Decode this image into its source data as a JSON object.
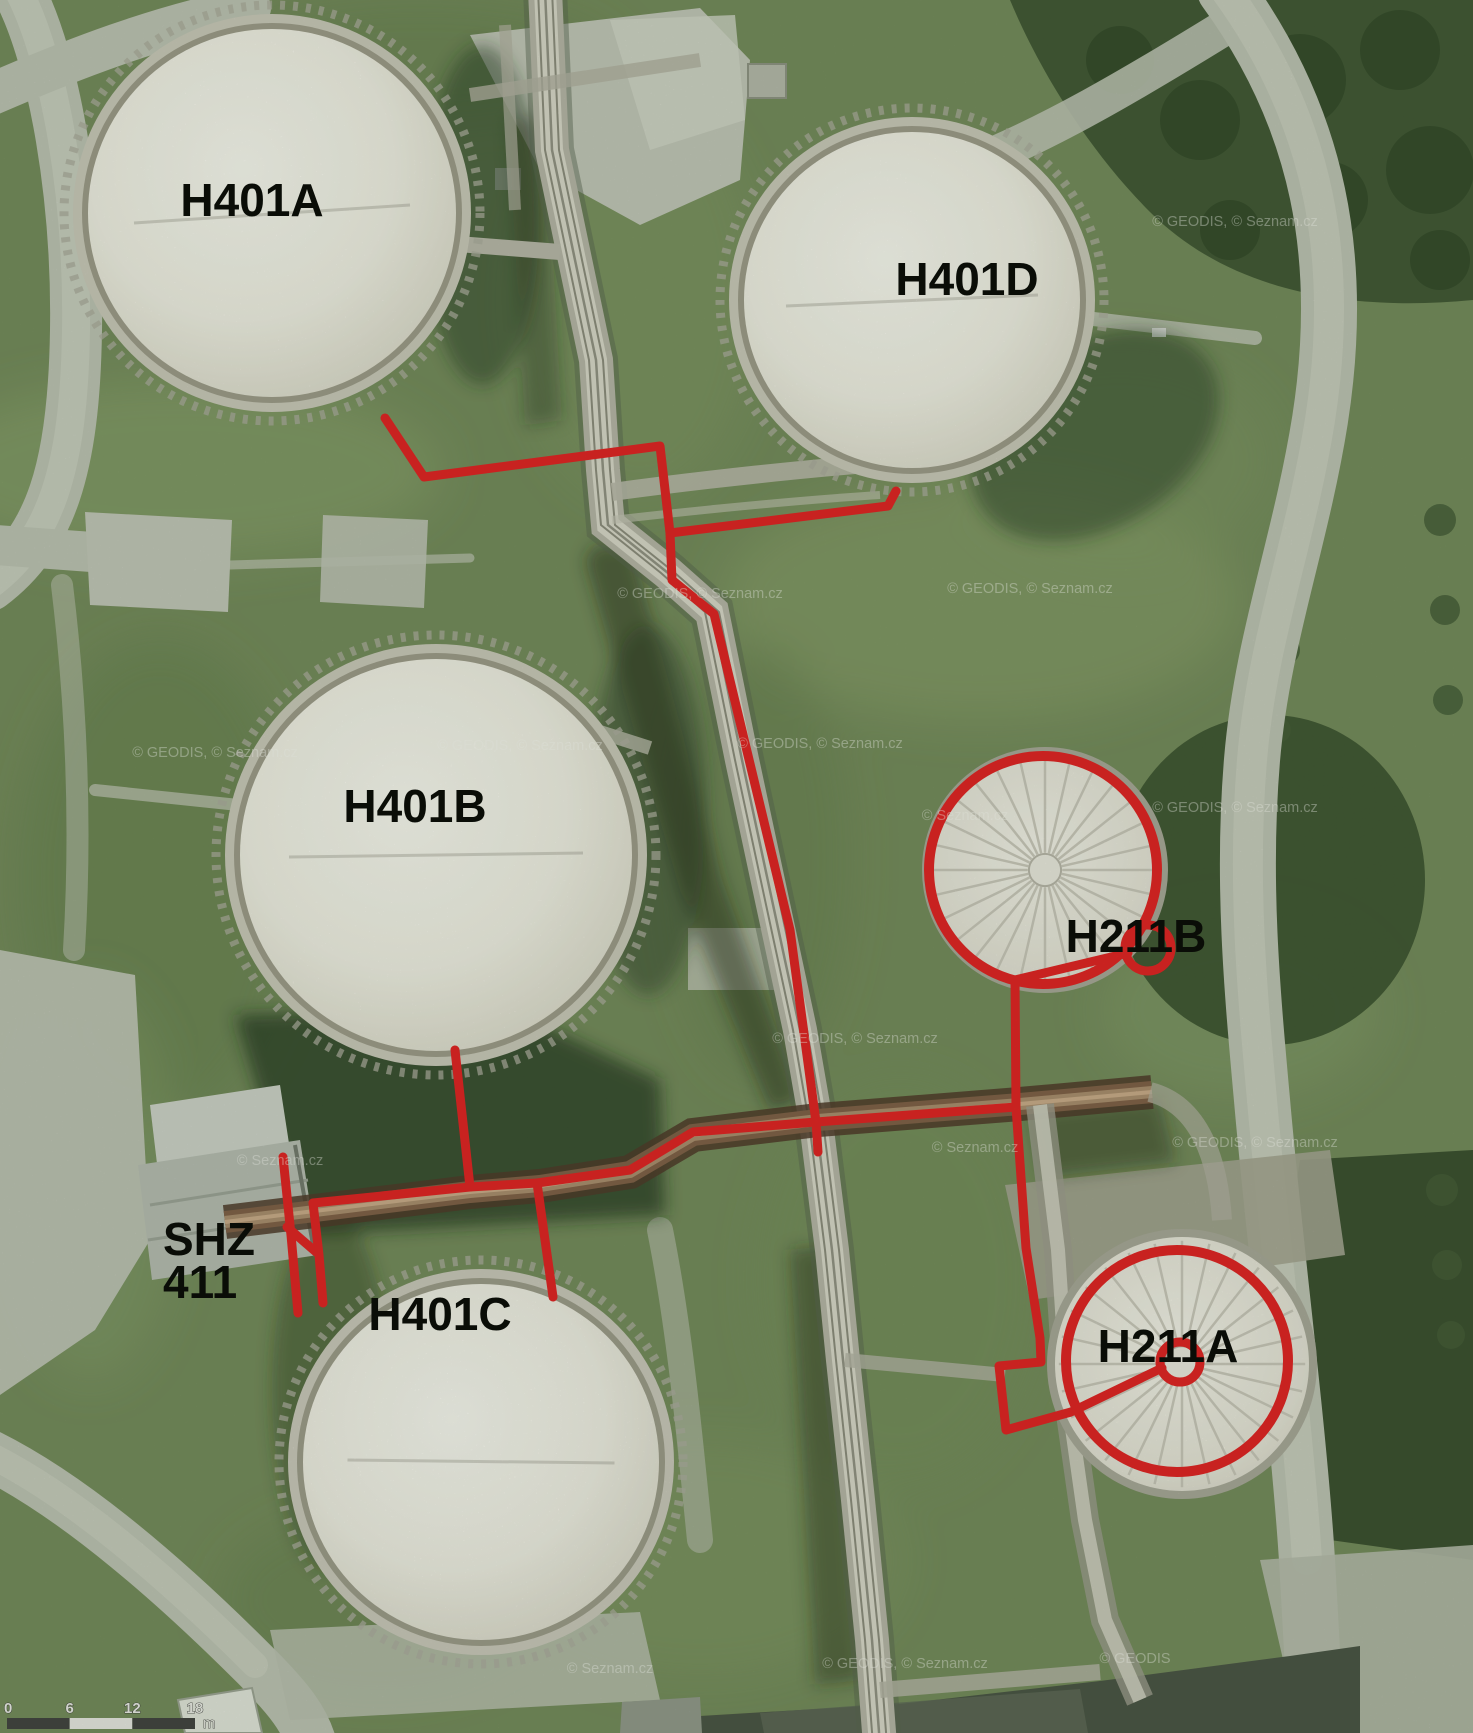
{
  "colors": {
    "annotation_red": "#e41a1d",
    "label_black": "#000000",
    "grass_base": "#71875a",
    "pavement": "#bdc1b5",
    "tank_white": "#f2f0e8",
    "scalebar_dark": "#3c3c3c",
    "scalebar_light": "#e9e9e6"
  },
  "tanks": [
    {
      "name": "H401A",
      "shape": "dome",
      "cx": 272,
      "cy": 213,
      "r": 184
    },
    {
      "name": "H401D",
      "shape": "dome",
      "cx": 912,
      "cy": 300,
      "r": 168
    },
    {
      "name": "H401B",
      "shape": "dome",
      "cx": 436,
      "cy": 855,
      "r": 196
    },
    {
      "name": "H401C",
      "shape": "dome",
      "cx": 481,
      "cy": 1462,
      "r": 178
    },
    {
      "name": "H211B",
      "shape": "cone",
      "cx": 1045,
      "cy": 870,
      "r": 115
    },
    {
      "name": "H211A",
      "shape": "cone",
      "cx": 1182,
      "cy": 1364,
      "r": 127
    }
  ],
  "labels": [
    {
      "id": "h401a",
      "text": "H401A",
      "x": 252,
      "y": 216,
      "size": 46,
      "anchor": "middle"
    },
    {
      "id": "h401d",
      "text": "H401D",
      "x": 967,
      "y": 295,
      "size": 46,
      "anchor": "middle"
    },
    {
      "id": "h401b",
      "text": "H401B",
      "x": 415,
      "y": 822,
      "size": 46,
      "anchor": "middle"
    },
    {
      "id": "h401c",
      "text": "H401C",
      "x": 440,
      "y": 1330,
      "size": 46,
      "anchor": "middle"
    },
    {
      "id": "h211b",
      "text": "H211B",
      "x": 1136,
      "y": 952,
      "size": 46,
      "anchor": "middle"
    },
    {
      "id": "h211a",
      "text": "H211A",
      "x": 1168,
      "y": 1362,
      "size": 46,
      "anchor": "middle"
    },
    {
      "id": "shz",
      "text": "SHZ",
      "x": 163,
      "y": 1255,
      "size": 46,
      "anchor": "start"
    },
    {
      "id": "shz-411",
      "text": "411",
      "x": 163,
      "y": 1298,
      "size": 46,
      "anchor": "start"
    }
  ],
  "red_overlay": {
    "stroke_width": 9,
    "polylines": [
      {
        "name": "h401a-branch",
        "points": [
          [
            385,
            418
          ],
          [
            424,
            477
          ],
          [
            660,
            446
          ],
          [
            670,
            533
          ]
        ]
      },
      {
        "name": "h401d-branch",
        "points": [
          [
            670,
            533
          ],
          [
            888,
            506
          ],
          [
            896,
            491
          ]
        ]
      },
      {
        "name": "main-north-south",
        "points": [
          [
            670,
            533
          ],
          [
            672,
            580
          ],
          [
            714,
            614
          ],
          [
            790,
            930
          ],
          [
            816,
            1122
          ],
          [
            818,
            1152
          ]
        ]
      },
      {
        "name": "west-header",
        "points": [
          [
            816,
            1122
          ],
          [
            693,
            1132
          ],
          [
            630,
            1170
          ],
          [
            537,
            1183
          ],
          [
            470,
            1187
          ],
          [
            313,
            1203
          ]
        ]
      },
      {
        "name": "shz-drop",
        "points": [
          [
            313,
            1203
          ],
          [
            319,
            1255
          ],
          [
            323,
            1303
          ]
        ]
      },
      {
        "name": "shz-diagonal",
        "points": [
          [
            287,
            1227
          ],
          [
            316,
            1252
          ]
        ]
      },
      {
        "name": "shz-vertical",
        "points": [
          [
            283,
            1157
          ],
          [
            291,
            1235
          ],
          [
            298,
            1313
          ]
        ]
      },
      {
        "name": "h401b-connector",
        "points": [
          [
            455,
            1050
          ],
          [
            470,
            1187
          ]
        ]
      },
      {
        "name": "h401c-connector",
        "points": [
          [
            537,
            1183
          ],
          [
            553,
            1297
          ]
        ]
      },
      {
        "name": "east-header",
        "points": [
          [
            816,
            1122
          ],
          [
            1016,
            1107
          ]
        ]
      },
      {
        "name": "h211b-riser",
        "points": [
          [
            1016,
            1107
          ],
          [
            1015,
            980
          ],
          [
            1128,
            953
          ]
        ]
      },
      {
        "name": "h211a-riser",
        "points": [
          [
            1016,
            1107
          ],
          [
            1026,
            1248
          ],
          [
            1040,
            1338
          ],
          [
            1041,
            1362
          ],
          [
            999,
            1366
          ],
          [
            1006,
            1430
          ],
          [
            1071,
            1412
          ],
          [
            1162,
            1368
          ]
        ]
      }
    ],
    "circles": [
      {
        "name": "h211b-ring",
        "cx": 1043,
        "cy": 870,
        "r": 114,
        "w": 10
      },
      {
        "name": "h211b-center",
        "cx": 1148,
        "cy": 948,
        "r": 23,
        "w": 9
      },
      {
        "name": "h211a-ring",
        "cx": 1177,
        "cy": 1361,
        "r": 111,
        "w": 10
      },
      {
        "name": "h211a-center",
        "cx": 1180,
        "cy": 1362,
        "r": 20,
        "w": 9
      }
    ]
  },
  "watermarks": [
    {
      "text": "© GEODIS, © Seznam.cz",
      "x": 1235,
      "y": 226
    },
    {
      "text": "© GEODIS, © Seznam.cz",
      "x": 1030,
      "y": 593
    },
    {
      "text": "© GEODIS, © Seznam.cz",
      "x": 700,
      "y": 598
    },
    {
      "text": "© GEODIS, © Seznam.cz",
      "x": 215,
      "y": 757
    },
    {
      "text": "© GEODIS, © Seznam.cz",
      "x": 520,
      "y": 750
    },
    {
      "text": "© GEODIS, © Seznam.cz",
      "x": 820,
      "y": 748
    },
    {
      "text": "© Seznam.cz",
      "x": 965,
      "y": 820
    },
    {
      "text": "© GEODIS, © Seznam.cz",
      "x": 1235,
      "y": 812
    },
    {
      "text": "© GEODIS, © Seznam.cz",
      "x": 855,
      "y": 1043
    },
    {
      "text": "© Seznam.cz",
      "x": 280,
      "y": 1165
    },
    {
      "text": "© Seznam.cz",
      "x": 975,
      "y": 1152
    },
    {
      "text": "© GEODIS, © Seznam.cz",
      "x": 1255,
      "y": 1147
    },
    {
      "text": "© Seznam.cz",
      "x": 610,
      "y": 1673
    },
    {
      "text": "© GEODIS, © Seznam.cz",
      "x": 905,
      "y": 1668
    },
    {
      "text": "© GEODIS",
      "x": 1135,
      "y": 1663
    }
  ],
  "scale_bar": {
    "x": 7,
    "y": 1718,
    "length": 188,
    "height": 11,
    "segment_colors": [
      "#3c3c3c",
      "#e9e9e6",
      "#3c3c3c"
    ],
    "ticks": [
      "0",
      "6",
      "12",
      "18"
    ],
    "unit": "m"
  }
}
